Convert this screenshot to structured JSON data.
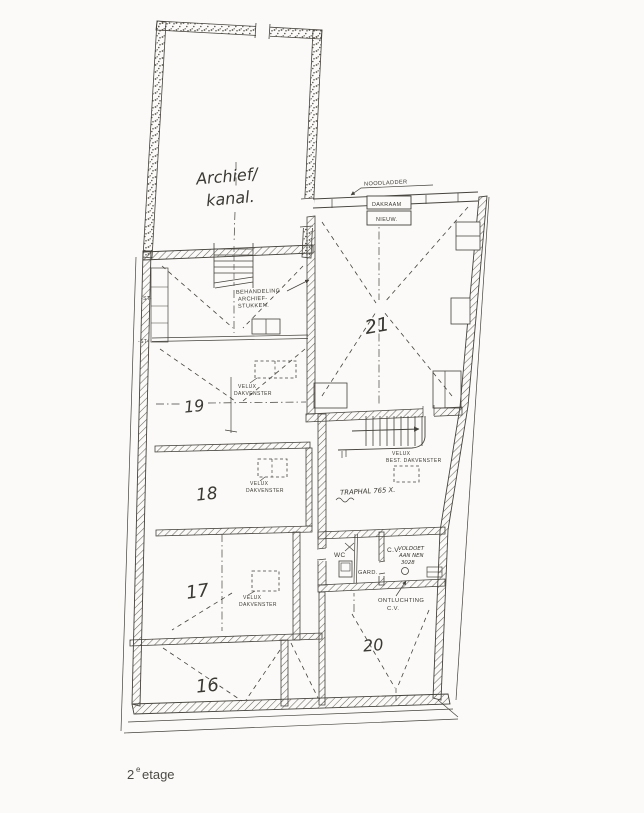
{
  "document": {
    "kind": "scanned-floor-plan",
    "caption": {
      "number": "2",
      "sup": "e",
      "word": "etage"
    }
  },
  "rooms": {
    "archief": {
      "line1": "Archief/",
      "line2": "kanal."
    },
    "r21": "21",
    "r19": "19",
    "r18": "18",
    "r17": "17",
    "r16": "16",
    "r20": "20",
    "wc": "WC",
    "gard": "GARD.",
    "cv": "C.V."
  },
  "annotations": {
    "noodladder": "NOODLADDER",
    "dakraam": {
      "line1": "DAKRAAM",
      "line2": "NIEUW."
    },
    "behandeling": {
      "line1": "BEHANDELING",
      "line2": "ARCHIEF-",
      "line3": "STUKKEN."
    },
    "velux": {
      "line1": "VELUX",
      "line2": "DAKVENSTER"
    },
    "velux_best": {
      "line1": "VELUX",
      "line2": "BEST. DAKVENSTER"
    },
    "traphal": "TRAPHAL 765 X.",
    "voldoet": {
      "line1": "VOLDOET",
      "line2": "AAN NEN",
      "line3": "3028"
    },
    "ontluchting": {
      "line1": "ONTLUCHTING",
      "line2": "C.V."
    },
    "st": "-ST-"
  },
  "colors": {
    "ink": "#45423c",
    "paper": "#fbfaf8",
    "wall_hatch": "#6a675f"
  }
}
